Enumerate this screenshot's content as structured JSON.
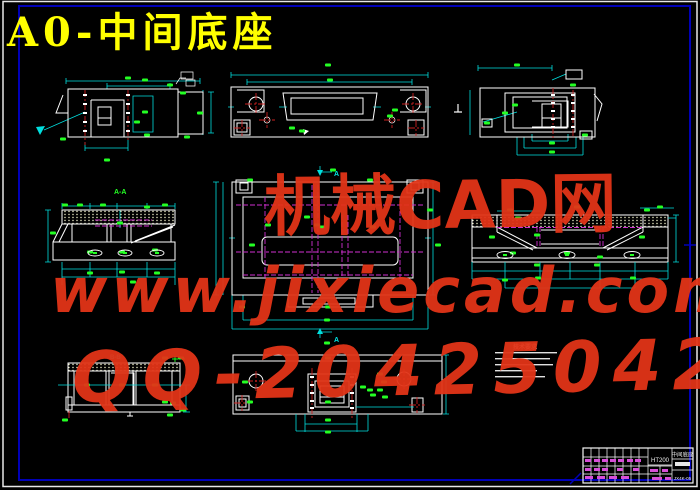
{
  "drawing_title": {
    "text": "A0-中间底座"
  },
  "watermark": {
    "line1": "机械CAD网",
    "line2": "www.jixiecad.com",
    "line3": "QQ-20425042"
  },
  "view_labels": {
    "section_aa": "A-A",
    "section_bb": "B-B",
    "cut_arrow": "A"
  },
  "tech_notes": {
    "title": "技术要求"
  },
  "title_block": {
    "material": "HT200",
    "part_name": "中间底座",
    "drawing_no": "JX4K-05"
  },
  "colors": {
    "title": "#ffff00",
    "watermark": "#e23418",
    "outline": "#ffffff",
    "dimension": "#00dede",
    "dim_text": "#24ff24",
    "centerline": "#cd2020",
    "hidden_line": "#cf2fcf",
    "frame": "#0000b8"
  }
}
